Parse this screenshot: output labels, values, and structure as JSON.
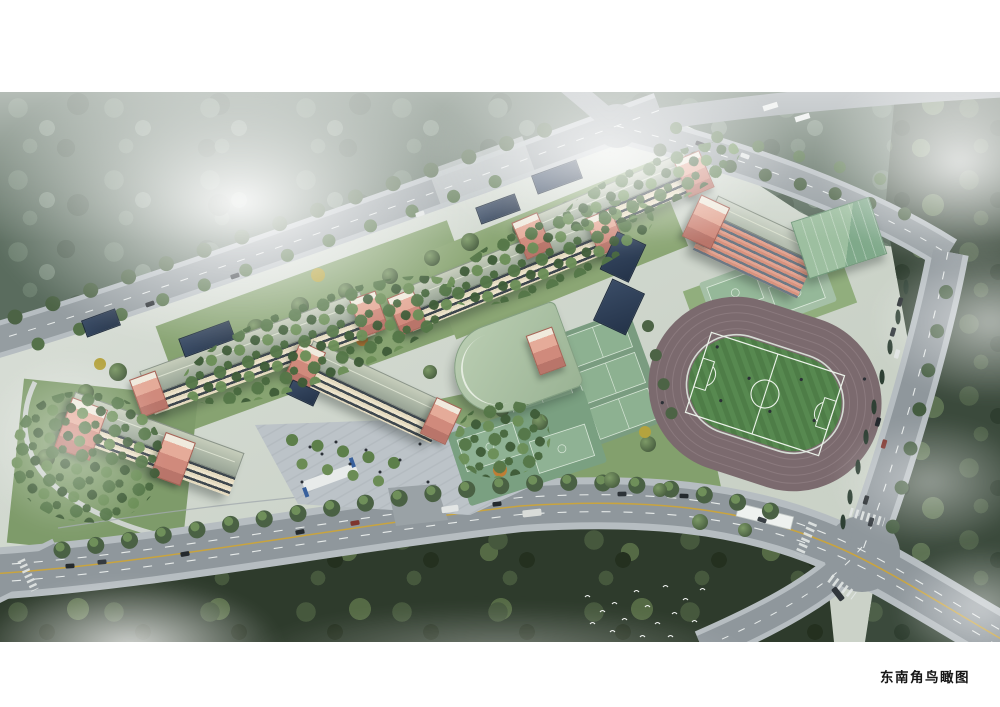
{
  "page": {
    "background": "#ffffff",
    "caption": "东南角鸟瞰图"
  },
  "palette": {
    "mist": "#ffffff",
    "forest_dark": "#2e3b2c",
    "forest_misty": "#5a6c5e",
    "lawn_green": "#86a271",
    "road_asphalt": "#8f979c",
    "road_marking_white": "#e7ebea",
    "road_marking_yellow": "#c9a43e",
    "track_surface": "#7b6a6e",
    "football_field_green": "#4e7d47",
    "field_stripe_green": "#578950",
    "court_green": "#8fb294",
    "building_wall_cream": "#e9e0c8",
    "window_band_dark": "#3e474e",
    "stair_tower_pink": "#d08a7e",
    "roof_gray_green": "#a9b3a4",
    "roof_navy": "#2e3d53",
    "plaza_paving": "#bcc3c8",
    "gym_roof_green": "#86ac90",
    "birds": "#f4f6f4"
  },
  "scene": {
    "view": "aerial bird's-eye architectural rendering of a school campus",
    "features": "classroom buildings with pink stair towers, running track with football field, tennis and basketball courts, entrance plaza, tree-lined roads with vehicles, forest belts, flock of white birds"
  }
}
